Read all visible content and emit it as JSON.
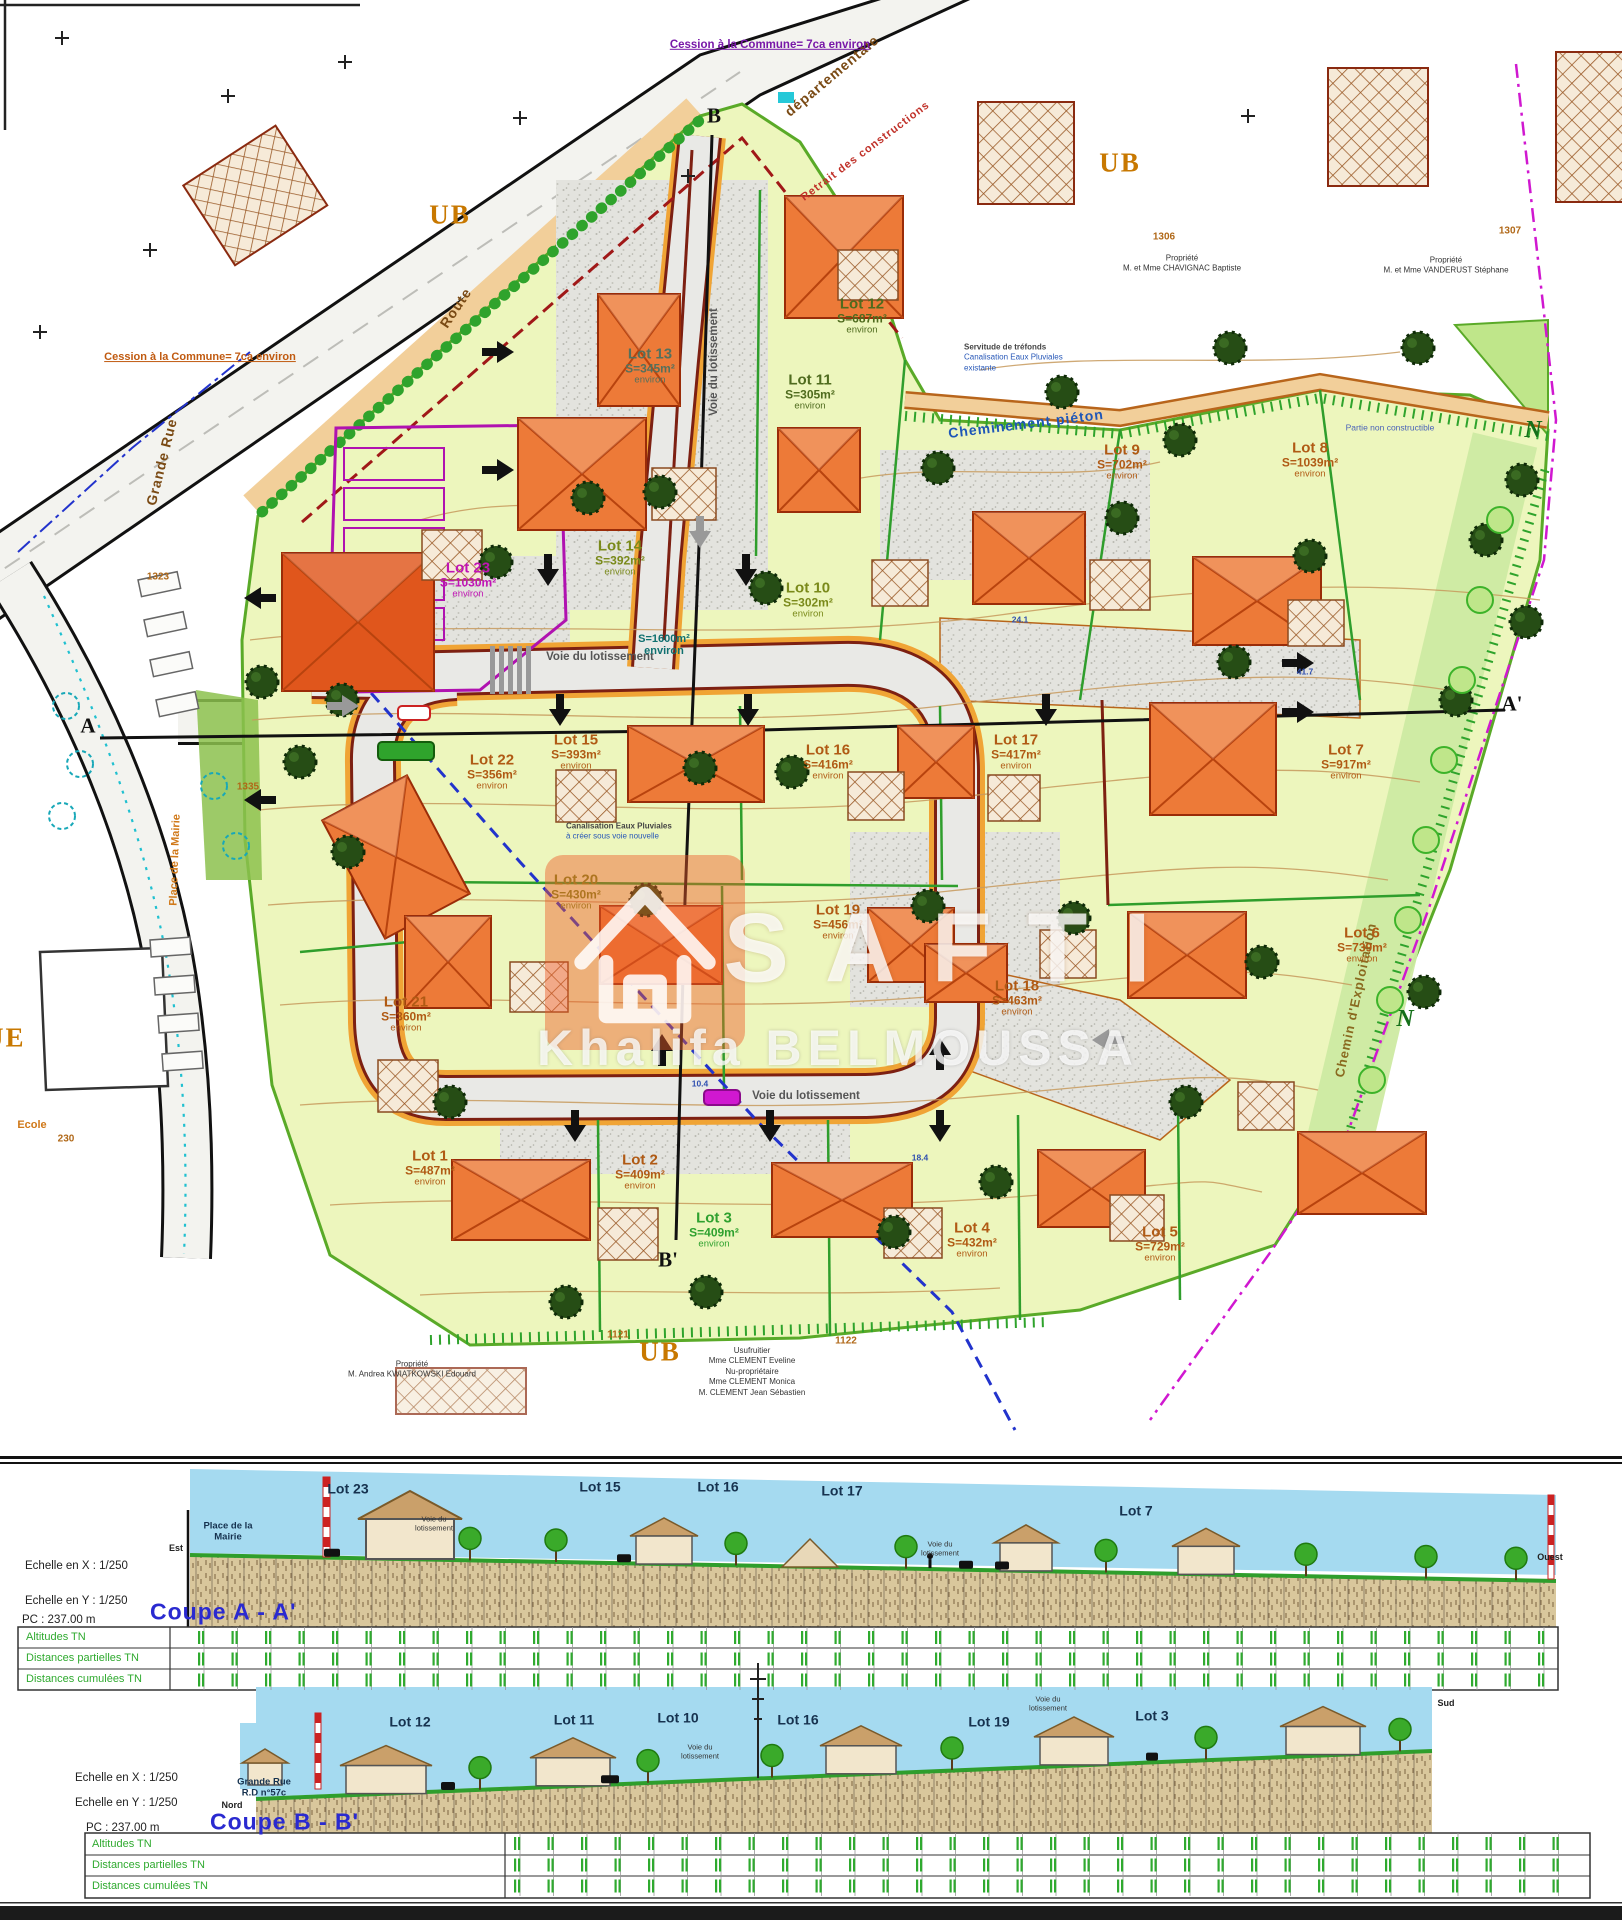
{
  "plan": {
    "zones": [
      {
        "t": "UB",
        "x": 450,
        "y": 215
      },
      {
        "t": "UB",
        "x": 1120,
        "y": 163
      },
      {
        "t": "UB",
        "x": 660,
        "y": 1352
      },
      {
        "t": "N",
        "x": 1533,
        "y": 431,
        "cls": "zone-n"
      },
      {
        "t": "N",
        "x": 1405,
        "y": 1020,
        "cls": "zone-n"
      }
    ],
    "streets": [
      {
        "t": "Route",
        "x": 456,
        "y": 308,
        "rot": -56,
        "cls": "street"
      },
      {
        "t": "départementale",
        "x": 832,
        "y": 76,
        "rot": -40,
        "cls": "street"
      },
      {
        "t": "Grande Rue",
        "x": 162,
        "y": 462,
        "rot": -76,
        "cls": "street"
      },
      {
        "t": "RUE",
        "x": -6,
        "y": 1038,
        "cls": "zone"
      },
      {
        "t": "Ecole",
        "x": 32,
        "y": 1126,
        "cls": "street-o"
      },
      {
        "t": "Place de la Mairie",
        "x": 176,
        "y": 860,
        "rot": -88,
        "cls": "street-o"
      },
      {
        "t": "Cheminement piéton",
        "x": 1026,
        "y": 424,
        "rot": -7,
        "cls": "street-b"
      },
      {
        "t": "Voie du lotissement",
        "x": 714,
        "y": 362,
        "rot": -90,
        "cls": "voie"
      },
      {
        "t": "Voie du lotissement",
        "x": 600,
        "y": 657,
        "cls": "voie"
      },
      {
        "t": "Voie du lotissement",
        "x": 806,
        "y": 1096,
        "cls": "voie"
      },
      {
        "t": "Chemin d'Exploitation",
        "x": 1356,
        "y": 1000,
        "rot": -78,
        "cls": "street-o2"
      },
      {
        "t": "Retrait des constructions",
        "x": 866,
        "y": 152,
        "rot": -37,
        "cls": "street-r"
      }
    ],
    "notes": [
      {
        "t": "Cession à la Commune= 7ca environ",
        "x": 770,
        "y": 45,
        "cls": "cession-p"
      },
      {
        "t": "Cession à la Commune= 7ca environ",
        "x": 200,
        "y": 358,
        "cls": "cession-o"
      },
      {
        "t": "Partie non constructible",
        "x": 1390,
        "y": 428,
        "cls": "tiny-b"
      }
    ],
    "annotations": [
      {
        "lines": [
          "Servitude de tréfonds",
          "Canalisation Eaux Pluviales",
          "existante"
        ],
        "x": 964,
        "y": 358,
        "cls": "anno"
      },
      {
        "lines": [
          "Canalisation Eaux Pluviales",
          "à créer sous voie nouvelle"
        ],
        "x": 566,
        "y": 832,
        "cls": "anno"
      },
      {
        "lines": [
          "S=1600m²",
          "environ"
        ],
        "x": 664,
        "y": 646,
        "cls": "voie-s"
      }
    ],
    "dims": [
      {
        "t": "24.1",
        "x": 1020,
        "y": 620
      },
      {
        "t": "41.7",
        "x": 1305,
        "y": 672
      },
      {
        "t": "18.4",
        "x": 920,
        "y": 1158
      },
      {
        "t": "10.4",
        "x": 700,
        "y": 1084
      }
    ],
    "parcels": [
      {
        "t": "1306",
        "x": 1164,
        "y": 238
      },
      {
        "t": "1307",
        "x": 1510,
        "y": 232
      },
      {
        "t": "1323",
        "x": 158,
        "y": 578
      },
      {
        "t": "1335",
        "x": 248,
        "y": 788
      },
      {
        "t": "230",
        "x": 66,
        "y": 1140
      },
      {
        "t": "1121",
        "x": 618,
        "y": 1336
      },
      {
        "t": "1122",
        "x": 846,
        "y": 1342
      }
    ],
    "markers": [
      {
        "t": "A",
        "x": 88,
        "y": 726
      },
      {
        "t": "A'",
        "x": 1512,
        "y": 704
      },
      {
        "t": "B",
        "x": 714,
        "y": 116
      },
      {
        "t": "B'",
        "x": 668,
        "y": 1260
      }
    ],
    "owners": [
      {
        "lines": [
          "Propriété",
          "M. et Mme CHAVIGNAC Baptiste"
        ],
        "x": 1182,
        "y": 264
      },
      {
        "lines": [
          "Propriété",
          "M. et Mme VANDERUST Stéphane"
        ],
        "x": 1446,
        "y": 266
      },
      {
        "lines": [
          "Propriété",
          "M. Andrea KWIATKOWSKI Edouard"
        ],
        "x": 412,
        "y": 1370
      },
      {
        "lines": [
          "Usufruitier",
          "Mme CLEMENT Eveline",
          "Nu-propriétaire",
          "Mme CLEMENT Monica",
          "M. CLEMENT Jean Sébastien"
        ],
        "x": 752,
        "y": 1372
      }
    ],
    "lots": [
      {
        "n": "Lot 1",
        "a": "S=487m²",
        "e": "environ",
        "c": "#b05a14",
        "x": 430,
        "y": 1168
      },
      {
        "n": "Lot 2",
        "a": "S=409m²",
        "e": "environ",
        "c": "#b05a14",
        "x": 640,
        "y": 1172
      },
      {
        "n": "Lot 3",
        "a": "S=409m²",
        "e": "environ",
        "c": "#2fa12f",
        "x": 714,
        "y": 1230
      },
      {
        "n": "Lot 4",
        "a": "S=432m²",
        "e": "environ",
        "c": "#b05a14",
        "x": 972,
        "y": 1240
      },
      {
        "n": "Lot 5",
        "a": "S=729m²",
        "e": "environ",
        "c": "#b05a14",
        "x": 1160,
        "y": 1244
      },
      {
        "n": "Lot 6",
        "a": "S=739m²",
        "e": "environ",
        "c": "#b05a14",
        "x": 1362,
        "y": 945
      },
      {
        "n": "Lot 7",
        "a": "S=917m²",
        "e": "environ",
        "c": "#b05a14",
        "x": 1346,
        "y": 762
      },
      {
        "n": "Lot 8",
        "a": "S=1039m²",
        "e": "environ",
        "c": "#b05a14",
        "x": 1310,
        "y": 460
      },
      {
        "n": "Lot 9",
        "a": "S=702m²",
        "e": "environ",
        "c": "#b05a14",
        "x": 1122,
        "y": 462
      },
      {
        "n": "Lot 10",
        "a": "S=302m²",
        "e": "environ",
        "c": "#7a8a1a",
        "x": 808,
        "y": 600
      },
      {
        "n": "Lot 11",
        "a": "S=305m²",
        "e": "environ",
        "c": "#4f6b1e",
        "x": 810,
        "y": 392
      },
      {
        "n": "Lot 12",
        "a": "S=687m²",
        "e": "environ",
        "c": "#4f6b1e",
        "x": 862,
        "y": 316
      },
      {
        "n": "Lot 13",
        "a": "S=345m²",
        "e": "environ",
        "c": "#55705c",
        "x": 650,
        "y": 366
      },
      {
        "n": "Lot 14",
        "a": "S=392m²",
        "e": "environ",
        "c": "#7a8a1a",
        "x": 620,
        "y": 558
      },
      {
        "n": "Lot 15",
        "a": "S=393m²",
        "e": "environ",
        "c": "#b05a14",
        "x": 576,
        "y": 752
      },
      {
        "n": "Lot 16",
        "a": "S=416m²",
        "e": "environ",
        "c": "#b05a14",
        "x": 828,
        "y": 762
      },
      {
        "n": "Lot 17",
        "a": "S=417m²",
        "e": "environ",
        "c": "#b05a14",
        "x": 1016,
        "y": 752
      },
      {
        "n": "Lot 18",
        "a": "S=463m²",
        "e": "environ",
        "c": "#b05a14",
        "x": 1017,
        "y": 998
      },
      {
        "n": "Lot 19",
        "a": "S=456m²",
        "e": "environ",
        "c": "#b05a14",
        "x": 838,
        "y": 922
      },
      {
        "n": "Lot 20",
        "a": "S=430m²",
        "e": "environ",
        "c": "#7a8a1a",
        "x": 576,
        "y": 892
      },
      {
        "n": "Lot 21",
        "a": "S=360m²",
        "e": "environ",
        "c": "#b05a14",
        "x": 406,
        "y": 1014
      },
      {
        "n": "Lot 22",
        "a": "S=356m²",
        "e": "environ",
        "c": "#b05a14",
        "x": 492,
        "y": 772
      },
      {
        "n": "Lot 23",
        "a": "S=1030m²",
        "e": "environ",
        "c": "#c014b4",
        "x": 468,
        "y": 580
      }
    ]
  },
  "watermark": {
    "brand": "SAFTI",
    "agent": "Khalifa BELMOUSSA"
  },
  "coupes": {
    "a": {
      "title": "Coupe A - A'",
      "scale_x": "Echelle en X : 1/250",
      "scale_y": "Echelle en Y : 1/250",
      "pc": "PC : 237.00 m",
      "rows": [
        "Altitudes TN",
        "Distances partielles TN",
        "Distances cumulées TN"
      ],
      "labels": [
        {
          "t": "Est",
          "x": 176,
          "y": 1549,
          "cls": "compass"
        },
        {
          "t": "Place de la Mairie",
          "x": 228,
          "y": 1532,
          "cls": "sec-place"
        },
        {
          "t": "Lot 23",
          "x": 348,
          "y": 1489,
          "cls": "sec-lot"
        },
        {
          "t": "Voie du lotissement",
          "x": 434,
          "y": 1524,
          "cls": "sec-small"
        },
        {
          "t": "Lot 15",
          "x": 600,
          "y": 1487,
          "cls": "sec-lot"
        },
        {
          "t": "Lot 16",
          "x": 718,
          "y": 1487,
          "cls": "sec-lot"
        },
        {
          "t": "Lot 17",
          "x": 842,
          "y": 1491,
          "cls": "sec-lot"
        },
        {
          "t": "Voie du lotissement",
          "x": 940,
          "y": 1549,
          "cls": "sec-small"
        },
        {
          "t": "Lot 7",
          "x": 1136,
          "y": 1511,
          "cls": "sec-lot"
        },
        {
          "t": "Ouest",
          "x": 1550,
          "y": 1558,
          "cls": "compass"
        }
      ]
    },
    "b": {
      "title": "Coupe B - B'",
      "scale_x": "Echelle en X : 1/250",
      "scale_y": "Echelle en Y : 1/250",
      "pc": "PC : 237.00 m",
      "rows": [
        "Altitudes TN",
        "Distances partielles TN",
        "Distances cumulées TN"
      ],
      "labels": [
        {
          "t": "Nord",
          "x": 232,
          "y": 1806,
          "cls": "compass"
        },
        {
          "t": "Grande Rue R.D n°57c",
          "x": 264,
          "y": 1788,
          "cls": "sec-place"
        },
        {
          "t": "Lot 12",
          "x": 410,
          "y": 1722,
          "cls": "sec-lot"
        },
        {
          "t": "Lot 11",
          "x": 574,
          "y": 1720,
          "cls": "sec-lot"
        },
        {
          "t": "Lot 10",
          "x": 678,
          "y": 1718,
          "cls": "sec-lot"
        },
        {
          "t": "Voie du lotissement",
          "x": 700,
          "y": 1752,
          "cls": "sec-small"
        },
        {
          "t": "Lot 16",
          "x": 798,
          "y": 1720,
          "cls": "sec-lot"
        },
        {
          "t": "Lot 19",
          "x": 989,
          "y": 1722,
          "cls": "sec-lot"
        },
        {
          "t": "Voie du lotissement",
          "x": 1048,
          "y": 1704,
          "cls": "sec-small"
        },
        {
          "t": "Lot 3",
          "x": 1152,
          "y": 1716,
          "cls": "sec-lot"
        },
        {
          "t": "Sud",
          "x": 1446,
          "y": 1704,
          "cls": "compass"
        }
      ]
    }
  }
}
